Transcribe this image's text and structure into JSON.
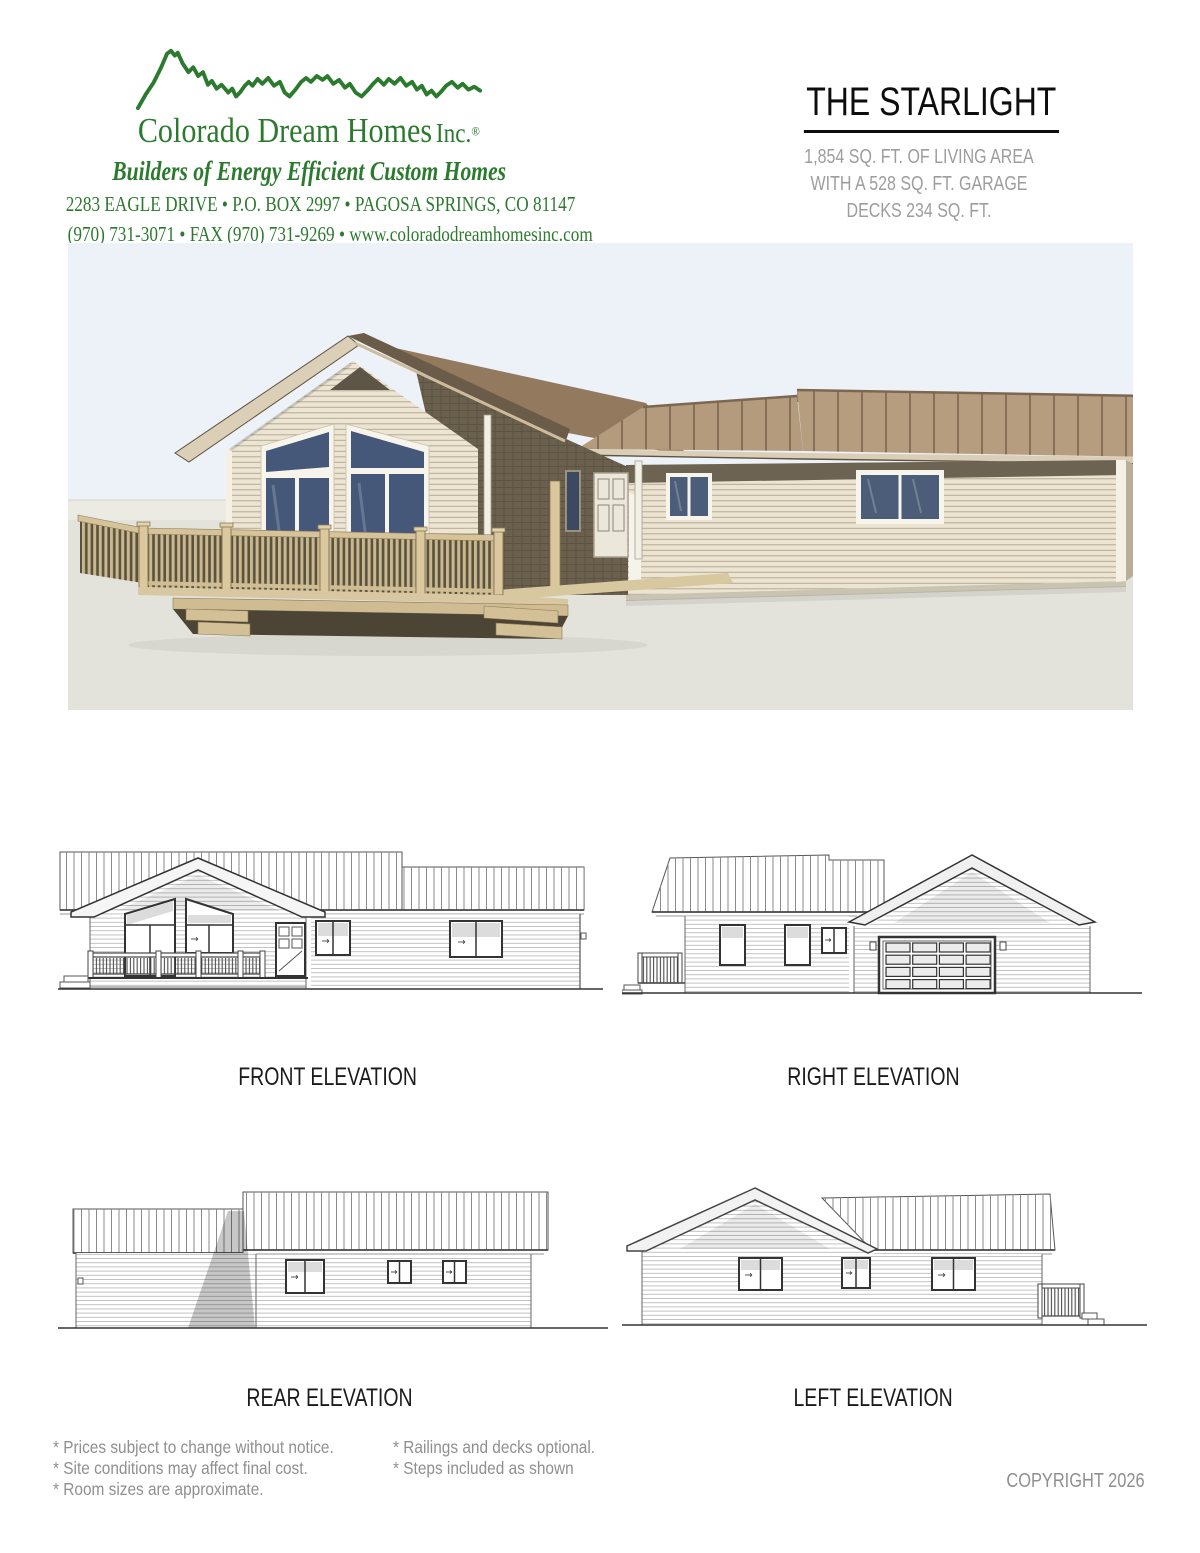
{
  "page": {
    "background": "#ffffff"
  },
  "header": {
    "brand_color": "#2c7a2e",
    "logo": "mountain-ridge",
    "company_name": "Colorado Dream Homes",
    "company_suffix": "Inc.",
    "registered_mark": "®",
    "tagline": "Builders of Energy Efficient Custom Homes",
    "address_line": "2283 EAGLE DRIVE  •  P.O. BOX 2997  •  PAGOSA SPRINGS, CO 81147",
    "contact_line": "(970) 731-3071  •  FAX (970) 731-9269  •  www.coloradodreamhomesinc.com"
  },
  "plan": {
    "title": "THE STARLIGHT",
    "specs": [
      "1,854 SQ. FT. OF LIVING AREA",
      "WITH A 528 SQ. FT. GARAGE",
      "DECKS 234 SQ. FT."
    ]
  },
  "rendering": {
    "alt": "3D exterior rendering of the Starlight home with front deck and covered porch",
    "palette": {
      "sky": "#edf1f8",
      "ground": "#e3e3dc",
      "roof_brown": "#b59b7d",
      "siding_cream": "#ece4d2",
      "shadow_olive": "#6b604d",
      "window_blue": "#4b5d79",
      "deck_tan": "#d6c39a"
    }
  },
  "elevations": {
    "front": "FRONT ELEVATION",
    "right": "RIGHT ELEVATION",
    "rear": "REAR ELEVATION",
    "left": "LEFT ELEVATION"
  },
  "footnotes": {
    "column1": [
      "* Prices subject to change without notice.",
      "* Site conditions may affect final cost.",
      "* Room sizes are approximate."
    ],
    "column2": [
      "* Railings and decks optional.",
      "* Steps included as shown"
    ]
  },
  "copyright": "COPYRIGHT 2026"
}
